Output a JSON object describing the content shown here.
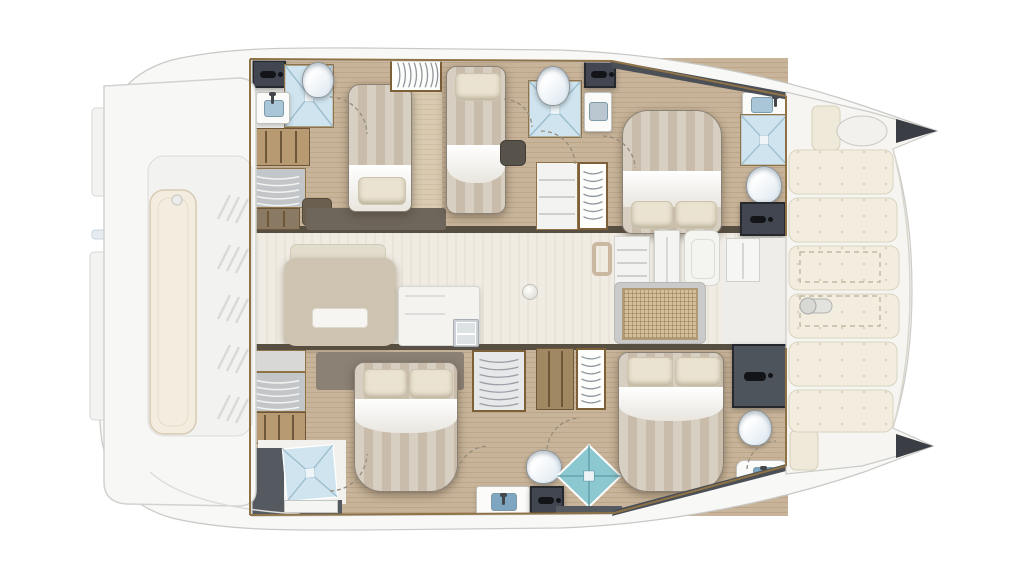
{
  "diagram": {
    "kind": "Catamaran yacht accommodation and deck plan, top-down view",
    "view": "top-down",
    "bow_direction": "right",
    "counts": {
      "double_berths": 4,
      "single_berths": 1,
      "bathrooms": 6,
      "showers": 6,
      "toilets": 6,
      "washbasins": 6,
      "foredeck_sunpads": 6,
      "foredeck_hatch_outlines": 2
    }
  },
  "colors": {
    "deck-white": "#f8f8f6",
    "hull-line": "#c8c8c5",
    "wood": "#c8b49a",
    "wood-grain": "#bda687",
    "wood-light": "#d9cab1",
    "salon-floor": "#f0ece3",
    "tile": "#f2f1ee",
    "shower-blue": "#cfe4ef",
    "shower-teal": "#8cc8d0",
    "charcoal": "#414650",
    "trim-gold": "#8f7347",
    "duvet-a": "#d8cfc3",
    "duvet-b": "#c9bcaa",
    "pillow": "#ebe3d1",
    "cushion": "#f2eddf",
    "island": "#cfc3b1",
    "rattan": "#d3c09b",
    "dark-band": "#584f43",
    "sheer-dark": "#4b4f56"
  },
  "exterior": {
    "aft_platform": {
      "name": "aft deck and tender platform",
      "features": [
        "bench-cushion",
        "deck-vents",
        "side-rails",
        "boarding-step"
      ]
    },
    "foredeck": {
      "name": "foredeck lounge",
      "sunpads": 6,
      "storage_hatches": 2,
      "windlass": true,
      "bow_pads": 2,
      "bow_hatch": 1
    },
    "bows": {
      "tips": 2
    }
  },
  "salon": {
    "name": "main-deck salon and galley",
    "items": [
      "galley-island-with-worktop",
      "counter-with-double-sink",
      "tall-refrigerator-locker",
      "storage-lockers",
      "rattan-top-table",
      "bar-stool",
      "forward-cockpit-door",
      "floor-socket"
    ]
  },
  "port_hull": {
    "position": "top",
    "name": "port hull accommodation",
    "rooms": [
      {
        "id": "aft-head",
        "type": "bathroom",
        "fixtures": [
          "storage-cabinet",
          "shower",
          "toilet",
          "washbasin",
          "locker"
        ]
      },
      {
        "id": "aft-storage",
        "type": "storage",
        "fixtures": [
          "linen-shelves",
          "shelf-unit",
          "seat"
        ]
      },
      {
        "id": "aft-cabin",
        "type": "cabin",
        "bed": "double",
        "fixtures": [
          "hanging-wardrobe",
          "aisle-step"
        ]
      },
      {
        "id": "mid-cabin",
        "type": "cabin",
        "bed": "single",
        "fixtures": [
          "seat"
        ]
      },
      {
        "id": "mid-head",
        "type": "bathroom",
        "fixtures": [
          "toilet",
          "shower",
          "washbasin",
          "storage-cabinet"
        ]
      },
      {
        "id": "mid-storage",
        "type": "storage",
        "fixtures": [
          "shelf-unit",
          "hanging-wardrobe"
        ]
      },
      {
        "id": "fwd-cabin",
        "type": "cabin",
        "bed": "double"
      },
      {
        "id": "fwd-head",
        "type": "bathroom",
        "fixtures": [
          "washbasin",
          "shower",
          "toilet",
          "storage-cabinet"
        ]
      }
    ]
  },
  "starboard_hull": {
    "position": "bottom",
    "name": "starboard hull accommodation",
    "rooms": [
      {
        "id": "aft-head",
        "type": "bathroom",
        "fixtures": [
          "shower",
          "vanity-shelf",
          "storage"
        ]
      },
      {
        "id": "aft-storage",
        "type": "storage",
        "fixtures": [
          "top-shelf",
          "linen-shelves",
          "shelf-unit"
        ]
      },
      {
        "id": "aft-cabin",
        "type": "cabin",
        "bed": "double",
        "fixtures": [
          "headboard-shelf"
        ]
      },
      {
        "id": "mid-storage",
        "type": "storage",
        "fixtures": [
          "hanging-wardrobe",
          "shelf-unit",
          "hanging-wardrobe"
        ]
      },
      {
        "id": "mid-head",
        "type": "bathroom",
        "fixtures": [
          "toilet",
          "washbasin",
          "storage-cabinet",
          "shower"
        ]
      },
      {
        "id": "fwd-cabin",
        "type": "cabin",
        "bed": "double"
      },
      {
        "id": "fwd-head",
        "type": "bathroom",
        "fixtures": [
          "shower",
          "toilet",
          "washbasin"
        ]
      }
    ]
  }
}
